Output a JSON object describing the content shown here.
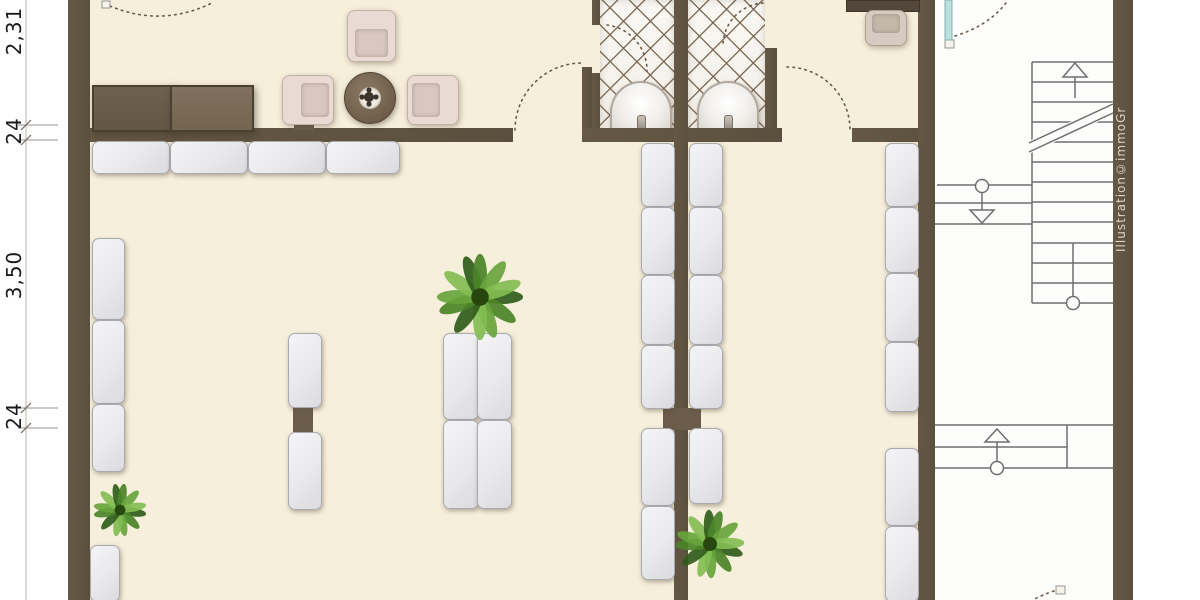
{
  "page": {
    "width": 1200,
    "height": 600,
    "kind": "floor-plan-illustration"
  },
  "colors": {
    "wall": "#5f5442",
    "floor_cream": "#f6efdb",
    "stair_hall_floor": "#fdfdfc",
    "cushion": "#ececef",
    "armchair": "#e9dbd4",
    "wood_dark": "#6a5c4c",
    "tile_line": "#78644e",
    "stair_line": "#6e6e6e",
    "door_arc": "#6b5a47",
    "glass_teal": "#bcdfdd",
    "plant_greens": [
      "#2f5c1b",
      "#4a8427",
      "#66a53b",
      "#82bd52"
    ]
  },
  "dimensions": {
    "line_x": 26,
    "ticks_y": [
      125,
      140,
      408,
      428
    ],
    "labels": [
      {
        "text": "2,31",
        "cx": 14,
        "cy": 33
      },
      {
        "text": "24",
        "cx": 14,
        "cy": 133
      },
      {
        "text": "3,50",
        "cx": 14,
        "cy": 277
      },
      {
        "text": "24",
        "cx": 14,
        "cy": 418
      }
    ]
  },
  "credit": {
    "text": "Illustration©immoGr"
  },
  "geometry": {
    "floors": [
      {
        "name": "floor-main-cream",
        "x": 68,
        "y": 0,
        "w": 867,
        "h": 600,
        "color": "#f6efdb"
      },
      {
        "name": "floor-stair-hall",
        "x": 935,
        "y": 0,
        "w": 178,
        "h": 600,
        "color": "#fdfdfc"
      }
    ],
    "tiles": [
      {
        "name": "bathroom-left-floor",
        "x": 600,
        "y": 0,
        "w": 74,
        "h": 133
      },
      {
        "name": "bathroom-right-floor",
        "x": 688,
        "y": 0,
        "w": 77,
        "h": 133
      }
    ],
    "walls": [
      {
        "name": "wall-exterior-left",
        "x": 68,
        "y": 0,
        "w": 22,
        "h": 600
      },
      {
        "name": "wall-lounge-south",
        "x": 90,
        "y": 128,
        "w": 423,
        "h": 14
      },
      {
        "name": "wall-door-stub",
        "x": 582,
        "y": 67,
        "w": 10,
        "h": 75
      },
      {
        "name": "wall-bath-south",
        "x": 582,
        "y": 128,
        "w": 200,
        "h": 14
      },
      {
        "name": "wall-office-south",
        "x": 852,
        "y": 128,
        "w": 83,
        "h": 14
      },
      {
        "name": "wall-bath-left-upper",
        "x": 592,
        "y": 0,
        "w": 8,
        "h": 25
      },
      {
        "name": "wall-bath-left-lower",
        "x": 592,
        "y": 73,
        "w": 8,
        "h": 55
      },
      {
        "name": "wall-center-spine",
        "x": 674,
        "y": 0,
        "w": 14,
        "h": 600
      },
      {
        "name": "wall-bath-right",
        "x": 765,
        "y": 48,
        "w": 12,
        "h": 80
      },
      {
        "name": "wall-stairhall-left",
        "x": 918,
        "y": 0,
        "w": 17,
        "h": 600
      },
      {
        "name": "wall-exterior-right",
        "x": 1113,
        "y": 0,
        "w": 20,
        "h": 600
      }
    ],
    "connectors": [
      {
        "x": 294,
        "y": 120,
        "w": 20,
        "h": 10
      },
      {
        "x": 293,
        "y": 406,
        "w": 20,
        "h": 26
      },
      {
        "x": 663,
        "y": 408,
        "w": 38,
        "h": 22
      }
    ],
    "sideboard": [
      {
        "tone": "dark",
        "x": 92,
        "y": 85,
        "w": 78,
        "h": 43
      },
      {
        "tone": "light",
        "x": 170,
        "y": 85,
        "w": 80,
        "h": 43
      }
    ],
    "desk": {
      "x": 846,
      "y": 0,
      "w": 72,
      "h": 10
    },
    "armchairs": [
      {
        "x": 347,
        "y": 10,
        "w": 47,
        "h": 50,
        "facing": "down",
        "variant": "lounge"
      },
      {
        "x": 282,
        "y": 75,
        "w": 50,
        "h": 48,
        "facing": "right",
        "variant": "lounge"
      },
      {
        "x": 407,
        "y": 75,
        "w": 50,
        "h": 48,
        "facing": "left",
        "variant": "lounge"
      },
      {
        "x": 865,
        "y": 10,
        "w": 40,
        "h": 34,
        "facing": "up",
        "variant": "office"
      }
    ],
    "table": {
      "cx": 369,
      "cy": 97,
      "r": 25
    },
    "sinks": [
      {
        "cx": 639,
        "cy": 106,
        "w": 58,
        "h": 50
      },
      {
        "cx": 726,
        "cy": 106,
        "w": 58,
        "h": 50
      }
    ],
    "plants": [
      {
        "cx": 480,
        "cy": 297,
        "r": 44
      },
      {
        "cx": 120,
        "cy": 510,
        "r": 27
      },
      {
        "cx": 710,
        "cy": 544,
        "r": 35
      }
    ],
    "cushions": [
      {
        "x": 92,
        "y": 141,
        "w": 76,
        "h": 31
      },
      {
        "x": 170,
        "y": 141,
        "w": 76,
        "h": 31
      },
      {
        "x": 248,
        "y": 141,
        "w": 76,
        "h": 31
      },
      {
        "x": 326,
        "y": 141,
        "w": 72,
        "h": 31
      },
      {
        "x": 92,
        "y": 238,
        "w": 31,
        "h": 80
      },
      {
        "x": 92,
        "y": 320,
        "w": 31,
        "h": 82
      },
      {
        "x": 92,
        "y": 404,
        "w": 31,
        "h": 66
      },
      {
        "x": 90,
        "y": 545,
        "w": 28,
        "h": 55
      },
      {
        "x": 288,
        "y": 333,
        "w": 32,
        "h": 73
      },
      {
        "x": 288,
        "y": 432,
        "w": 32,
        "h": 76
      },
      {
        "x": 443,
        "y": 333,
        "w": 34,
        "h": 85
      },
      {
        "x": 477,
        "y": 333,
        "w": 33,
        "h": 85
      },
      {
        "x": 443,
        "y": 420,
        "w": 34,
        "h": 87
      },
      {
        "x": 477,
        "y": 420,
        "w": 33,
        "h": 87
      },
      {
        "x": 641,
        "y": 143,
        "w": 32,
        "h": 62
      },
      {
        "x": 641,
        "y": 207,
        "w": 32,
        "h": 66
      },
      {
        "x": 641,
        "y": 275,
        "w": 32,
        "h": 68
      },
      {
        "x": 641,
        "y": 345,
        "w": 32,
        "h": 62
      },
      {
        "x": 641,
        "y": 428,
        "w": 32,
        "h": 76
      },
      {
        "x": 641,
        "y": 506,
        "w": 32,
        "h": 72
      },
      {
        "x": 689,
        "y": 143,
        "w": 32,
        "h": 62
      },
      {
        "x": 689,
        "y": 207,
        "w": 32,
        "h": 66
      },
      {
        "x": 689,
        "y": 275,
        "w": 32,
        "h": 68
      },
      {
        "x": 689,
        "y": 345,
        "w": 32,
        "h": 62
      },
      {
        "x": 689,
        "y": 428,
        "w": 32,
        "h": 74
      },
      {
        "x": 885,
        "y": 143,
        "w": 32,
        "h": 62
      },
      {
        "x": 885,
        "y": 207,
        "w": 32,
        "h": 64
      },
      {
        "x": 885,
        "y": 273,
        "w": 32,
        "h": 67
      },
      {
        "x": 885,
        "y": 342,
        "w": 32,
        "h": 68
      },
      {
        "x": 885,
        "y": 448,
        "w": 32,
        "h": 76
      },
      {
        "x": 885,
        "y": 526,
        "w": 32,
        "h": 74
      }
    ],
    "stairs": {
      "lines": [
        [
          1032,
          62,
          1113,
          62
        ],
        [
          1032,
          62,
          1032,
          303
        ],
        [
          1032,
          82,
          1113,
          82
        ],
        [
          1032,
          102,
          1113,
          102
        ],
        [
          1032,
          122,
          1113,
          122
        ],
        [
          1032,
          142,
          1113,
          142
        ],
        [
          1032,
          162,
          1113,
          162
        ],
        [
          1032,
          182,
          1113,
          182
        ],
        [
          1032,
          202,
          1113,
          202
        ],
        [
          1032,
          222,
          1113,
          222
        ],
        [
          1032,
          243,
          1113,
          243
        ],
        [
          1032,
          263,
          1113,
          263
        ],
        [
          1032,
          283,
          1113,
          283
        ],
        [
          1032,
          303,
          1113,
          303
        ],
        [
          1073,
          243,
          1073,
          303
        ],
        [
          1075,
          77,
          1075,
          98
        ],
        [
          937,
          185,
          1032,
          185
        ],
        [
          982,
          192,
          982,
          210
        ],
        [
          935,
          203,
          1032,
          203
        ],
        [
          935,
          224,
          1032,
          224
        ],
        [
          935,
          425,
          1113,
          425
        ],
        [
          935,
          447,
          1067,
          447
        ],
        [
          935,
          468,
          1113,
          468
        ],
        [
          1067,
          425,
          1067,
          468
        ],
        [
          997,
          442,
          997,
          462
        ]
      ],
      "break_mask": "1029,141 1113,102 1113,115 1029,154",
      "break_lines": [
        [
          1029,
          143,
          1113,
          104
        ],
        [
          1029,
          152,
          1113,
          113
        ]
      ],
      "circles": [
        [
          1073,
          303
        ],
        [
          982,
          186
        ],
        [
          997,
          468
        ]
      ],
      "triangles": [
        {
          "pts": "1063,77 1087,77 1075,63",
          "dir": "up"
        },
        {
          "pts": "970,210 994,210 982,223",
          "dir": "down"
        },
        {
          "pts": "985,442 1009,442 997,429",
          "dir": "up"
        }
      ]
    },
    "door_arcs": [
      "M110,6 Q162,28 214,2",
      "M515,130 A67,67 0 0 1 582,63",
      "M607,25 A46,46 0 0 1 647,71",
      "M763,3 A43,43 0 0 0 723,47",
      "M787,67 A63,63 0 0 1 850,130",
      "M955,36 Q988,26 1006,3",
      "M1054,591 Q1042,595 1033,600"
    ],
    "hinges": [
      {
        "x": 102,
        "y": 1,
        "w": 8,
        "h": 7
      },
      {
        "x": 945,
        "y": 40,
        "w": 9,
        "h": 8
      },
      {
        "x": 1056,
        "y": 586,
        "w": 9,
        "h": 8
      }
    ],
    "glass_door": {
      "x": 945,
      "y": 0,
      "w": 7,
      "h": 40
    }
  }
}
